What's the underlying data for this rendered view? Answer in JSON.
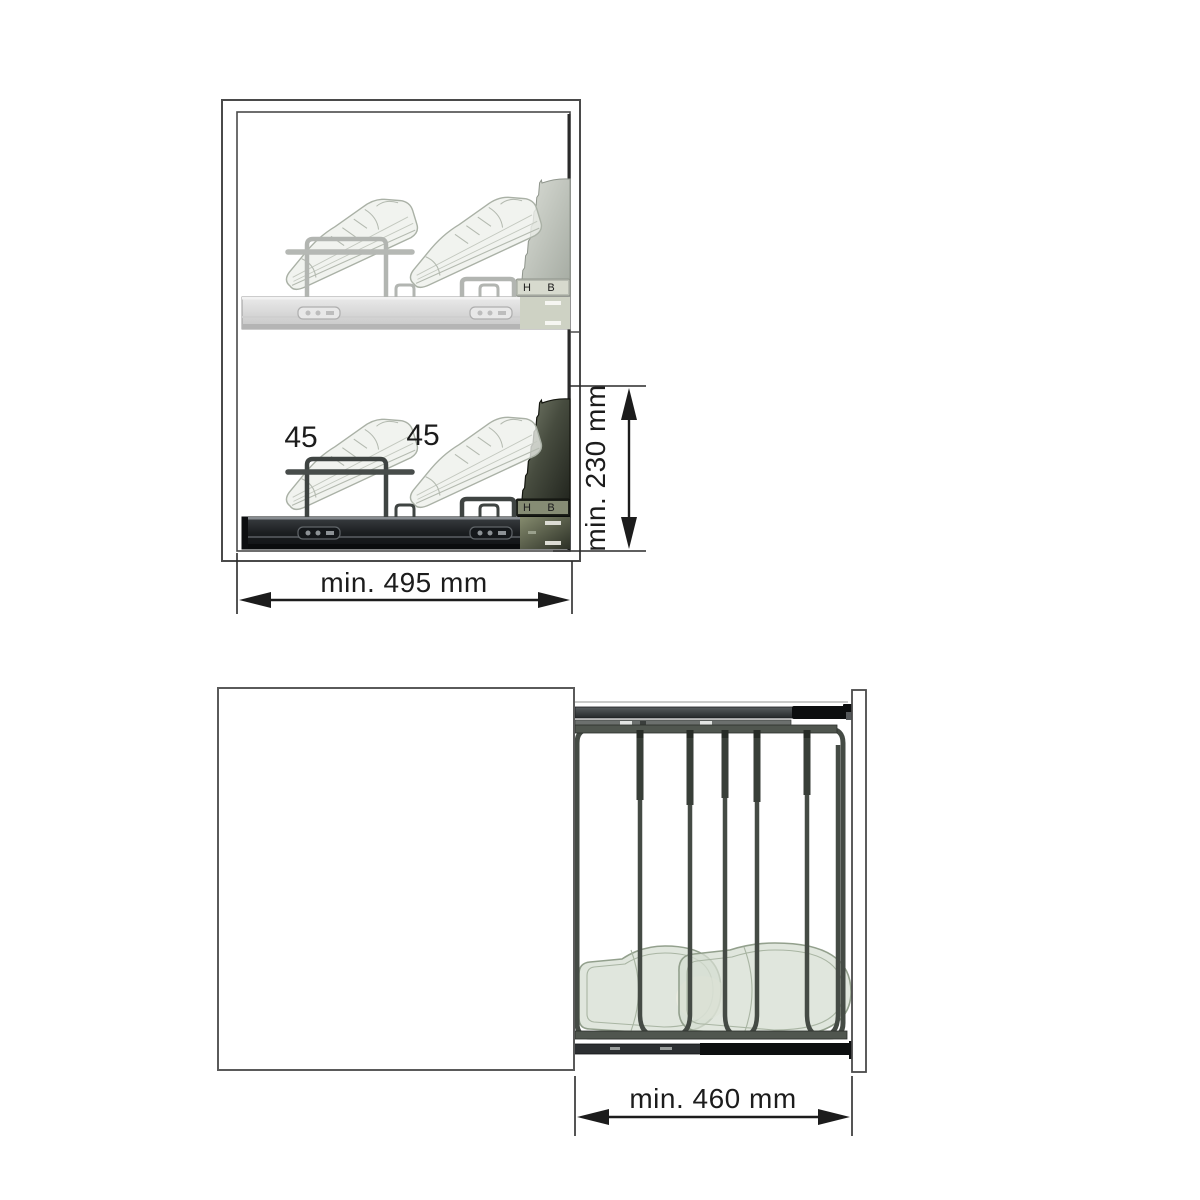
{
  "diagram": {
    "side_view": {
      "angle_label_1": "45",
      "angle_label_2": "45",
      "height_dimension": "min. 230 mm",
      "width_dimension": "min. 495 mm",
      "bracket_mark_h": "H",
      "bracket_mark_b": "B"
    },
    "top_view": {
      "width_dimension": "min. 460 mm"
    },
    "colors": {
      "dimension_line": "#1c1c1c",
      "cabinet_outline": "#4a4a4a",
      "ghost_rack_gray": "#b3b6b0",
      "dark_rail": "#1b1e20",
      "olive_accent": "#767c62",
      "wire_frame_green_gray": "#454b45",
      "shoe_ghost_fill": "#d5ded1",
      "shoe_ghost_outline": "#93a08d"
    }
  }
}
